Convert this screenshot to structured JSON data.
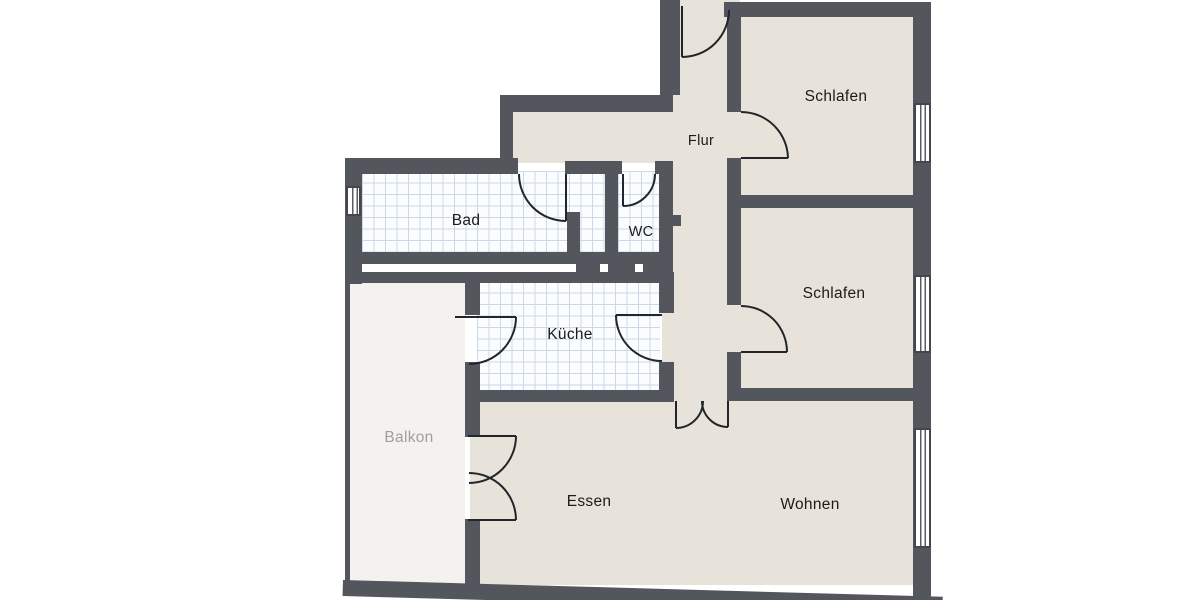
{
  "colors": {
    "wall": "#53575d",
    "floor": "#e8e3da",
    "tile_bg": "#fbfcfe",
    "tile_line": "#c8dae8",
    "balcony_floor": "#f3f2ee",
    "door_line": "#22262b",
    "label": "#1b1b1b",
    "balcony_label": "#a09f9c",
    "background": "#ffffff"
  },
  "rooms": {
    "schlafen_top": {
      "label": "Schlafen"
    },
    "schlafen_mid": {
      "label": "Schlafen"
    },
    "flur": {
      "label": "Flur"
    },
    "bad": {
      "label": "Bad"
    },
    "wc": {
      "label": "WC"
    },
    "kueche": {
      "label": "Küche"
    },
    "balkon": {
      "label": "Balkon"
    },
    "essen": {
      "label": "Essen"
    },
    "wohnen": {
      "label": "Wohnen"
    }
  }
}
